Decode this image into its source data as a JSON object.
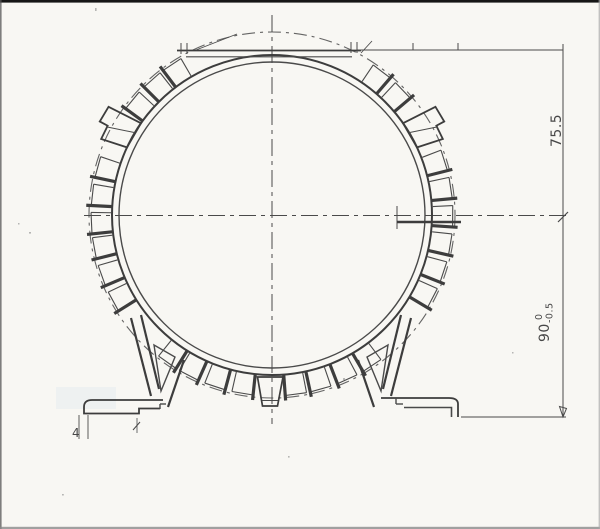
{
  "drawing": {
    "center": {
      "x": 272,
      "y": 215
    },
    "radii": {
      "envelope": 183,
      "wall_outer": 160,
      "wall_inner": 153
    },
    "fin": {
      "span": 6.8,
      "inner": 161,
      "outer": 181,
      "bar_inner": 159.5,
      "bar_outer": 186
    },
    "fin_angles": [
      34,
      43,
      69,
      78,
      87,
      96,
      105,
      114,
      143,
      152,
      161,
      169,
      186,
      195,
      204,
      212,
      238,
      247,
      256,
      264,
      273,
      282,
      306,
      315,
      323
    ],
    "lugs": [
      {
        "angle": 61,
        "mirror": 1
      },
      {
        "angle": 299,
        "mirror": -1
      }
    ]
  },
  "dimensions": {
    "top_to_center": "75.5",
    "shaft_height": "90",
    "shaft_height_tol_upper": "0",
    "shaft_height_tol_lower": "-0.5",
    "foot_detail": "4"
  },
  "colors": {
    "paper": "#f8f7f3",
    "line": "#4a4a4a",
    "line_dark": "#3d3d3d",
    "scan_border": "#161616"
  }
}
